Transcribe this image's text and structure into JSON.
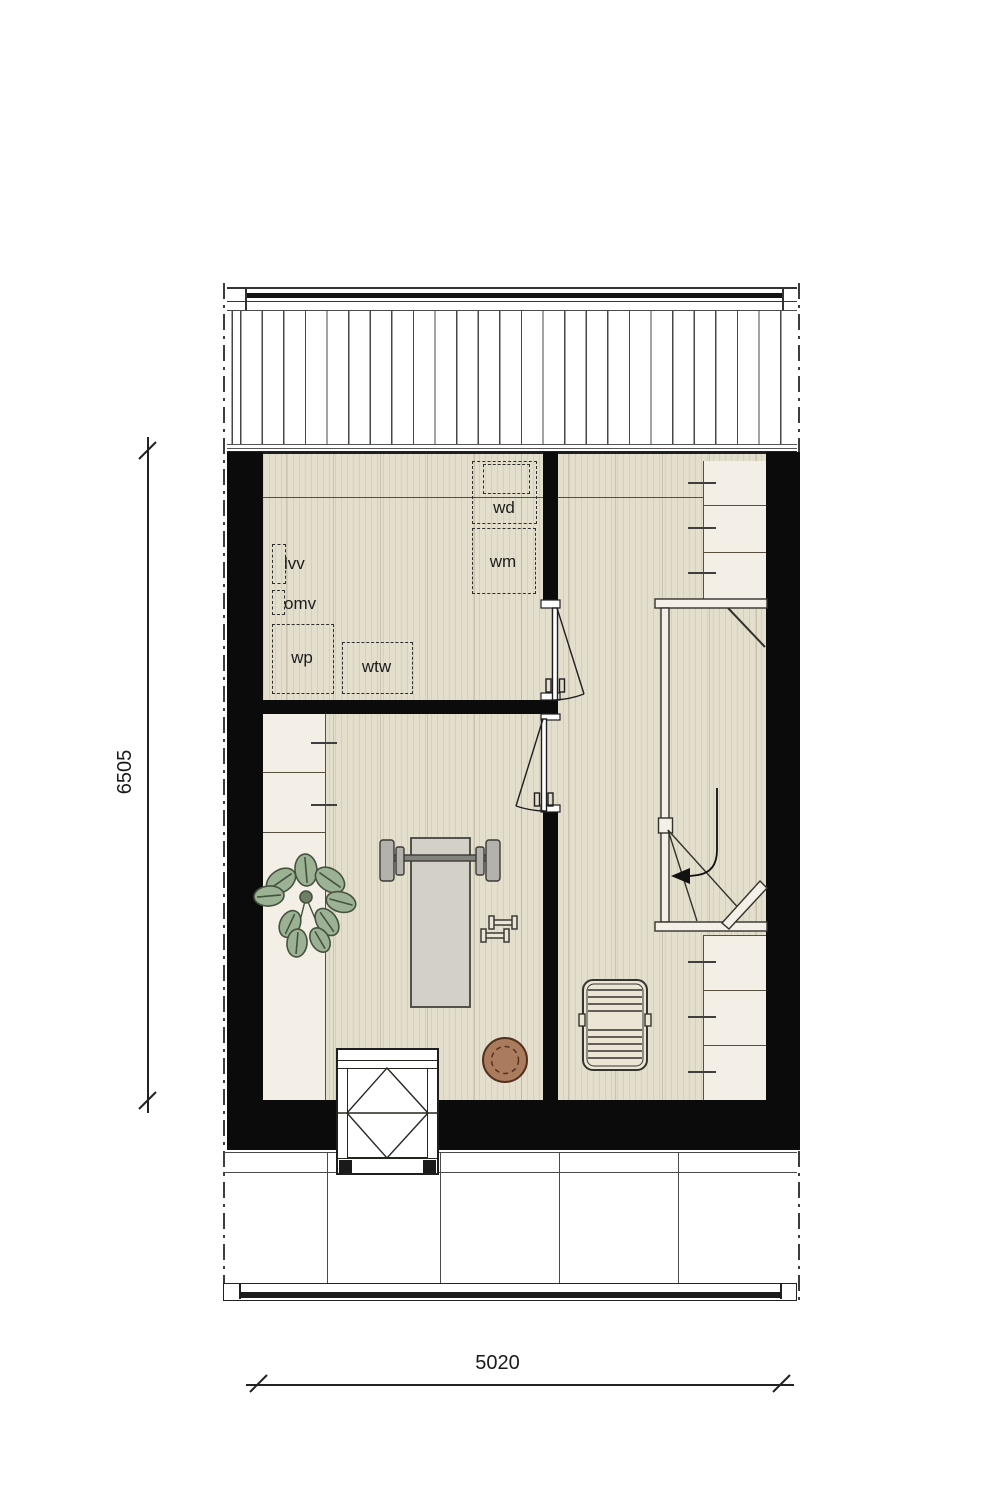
{
  "plan": {
    "unit_labels": {
      "wd": "wd",
      "wm": "wm",
      "lvv": "lvv",
      "omv": "omv",
      "wp": "wp",
      "wtw": "wtw"
    },
    "dimensions": {
      "vertical_mm": "6505",
      "horizontal_mm": "5020"
    },
    "palette": {
      "wall": "#0b0b0b",
      "floor": "#e4decd",
      "cabinet": "#f3efe6",
      "bench": "#d3d0c8",
      "plant": "#9cb295",
      "ball": "#ab7b5e",
      "linework": "#2e2e2e"
    }
  }
}
